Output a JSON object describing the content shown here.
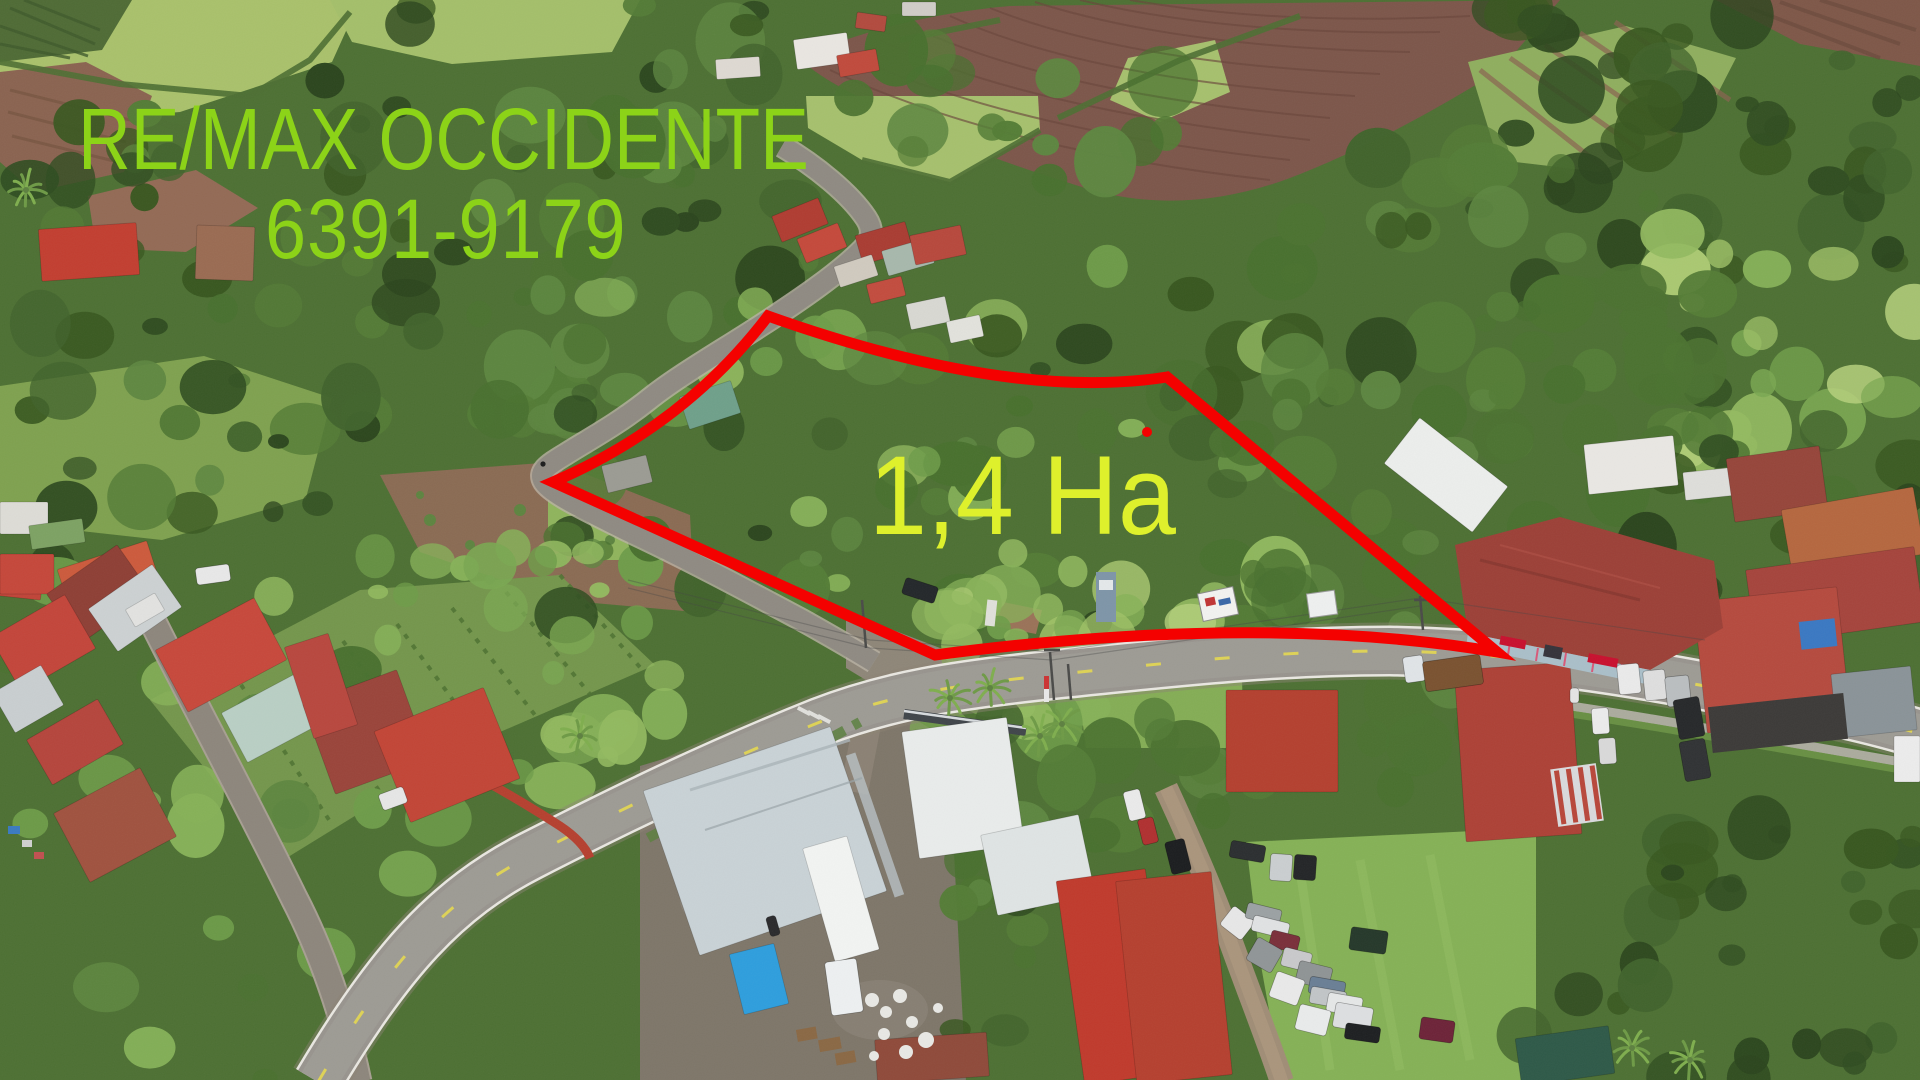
{
  "image": {
    "width": 1920,
    "height": 1080,
    "description": "Aerial drone photograph of a 1.4 hectare forested property for sale, outlined in red, beside a curving two-lane road through a Costa Rican village with red-roofed houses, farm fields and tropical forest"
  },
  "overlay": {
    "brand": "RE/MAX OCCIDENTE",
    "phone": "6391-9179",
    "area_label": "1,4 Ha"
  },
  "annotation_colors": {
    "brand_green": "#8cd318",
    "area_yellow": "#def02c",
    "boundary_red": "#f40100"
  }
}
